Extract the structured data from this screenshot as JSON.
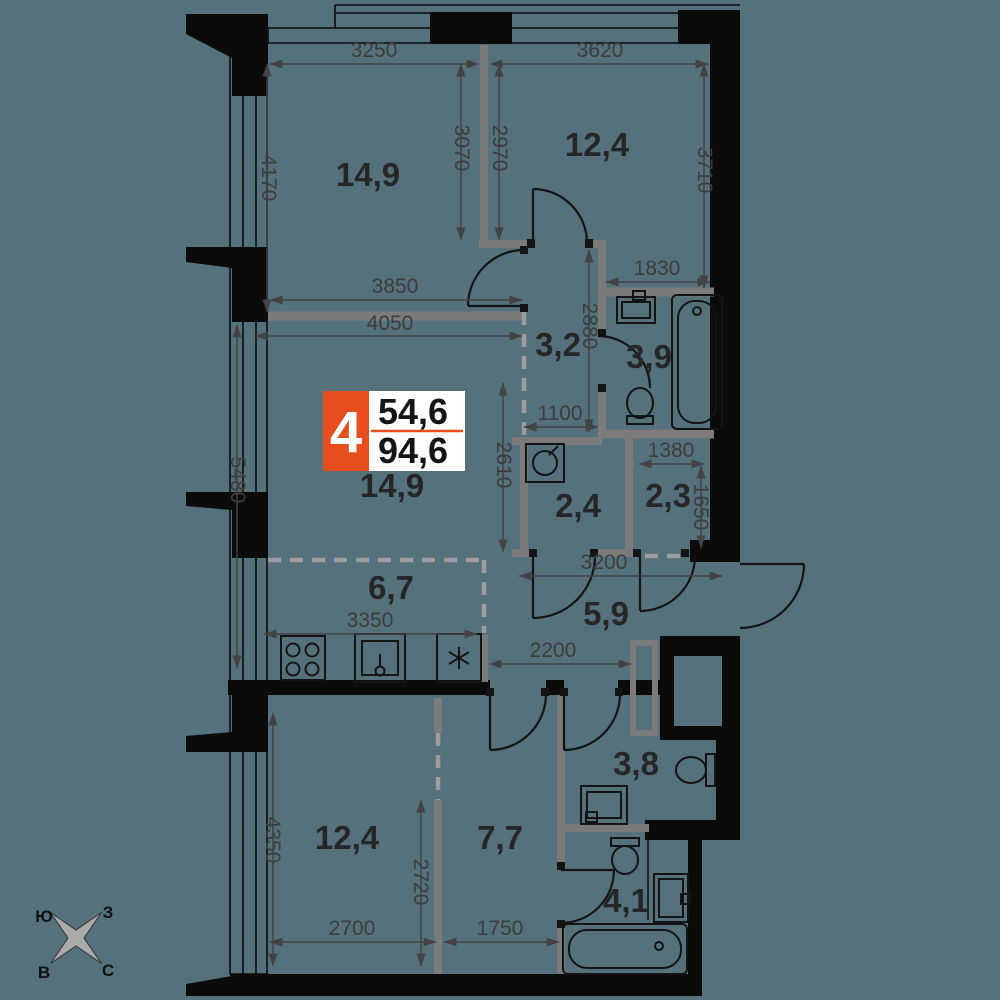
{
  "badge": {
    "number": "4",
    "area_living": "54,6",
    "area_total": "94,6"
  },
  "rooms": {
    "bedroom_top_left": "14,9",
    "bedroom_top_right": "12,4",
    "hall_upper": "3,2",
    "bathroom_upper": "3,9",
    "living_room": "14,9",
    "storage_small": "2,4",
    "storage": "2,3",
    "kitchen": "6,7",
    "hallway": "5,9",
    "bedroom_bottom_left": "12,4",
    "bedroom_bottom_mid": "7,7",
    "wc_bottom": "3,8",
    "bathroom_bottom": "4,1"
  },
  "dimensions": {
    "top_left_width": "3250",
    "top_right_width": "3620",
    "top_left_height": "4170",
    "partition_height": "3070",
    "top_right_inner_height": "2970",
    "top_right_height": "3710",
    "bath_upper_width": "1830",
    "wall_mid_width": "3850",
    "living_width": "4050",
    "hall_upper_height": "2880",
    "hall_upper_width": "1100",
    "living_height_left": "5480",
    "living_height_right": "2610",
    "storage_width": "1380",
    "storage_height": "1650",
    "hallway_width": "3200",
    "hallway_neck_width": "2200",
    "kitchen_width": "3350",
    "bottom_left_width": "2700",
    "bottom_mid_width": "1750",
    "bottom_height": "4350",
    "bottom_partition_height": "2720"
  },
  "compass": {
    "south": "Ю",
    "west": "З",
    "east": "В",
    "north": "С"
  },
  "colors": {
    "background": "#54717c",
    "walls": "#0b0b0b",
    "partitions": "#7b7b7b",
    "accent": "#e84e1d",
    "dimensions": "#434343"
  }
}
